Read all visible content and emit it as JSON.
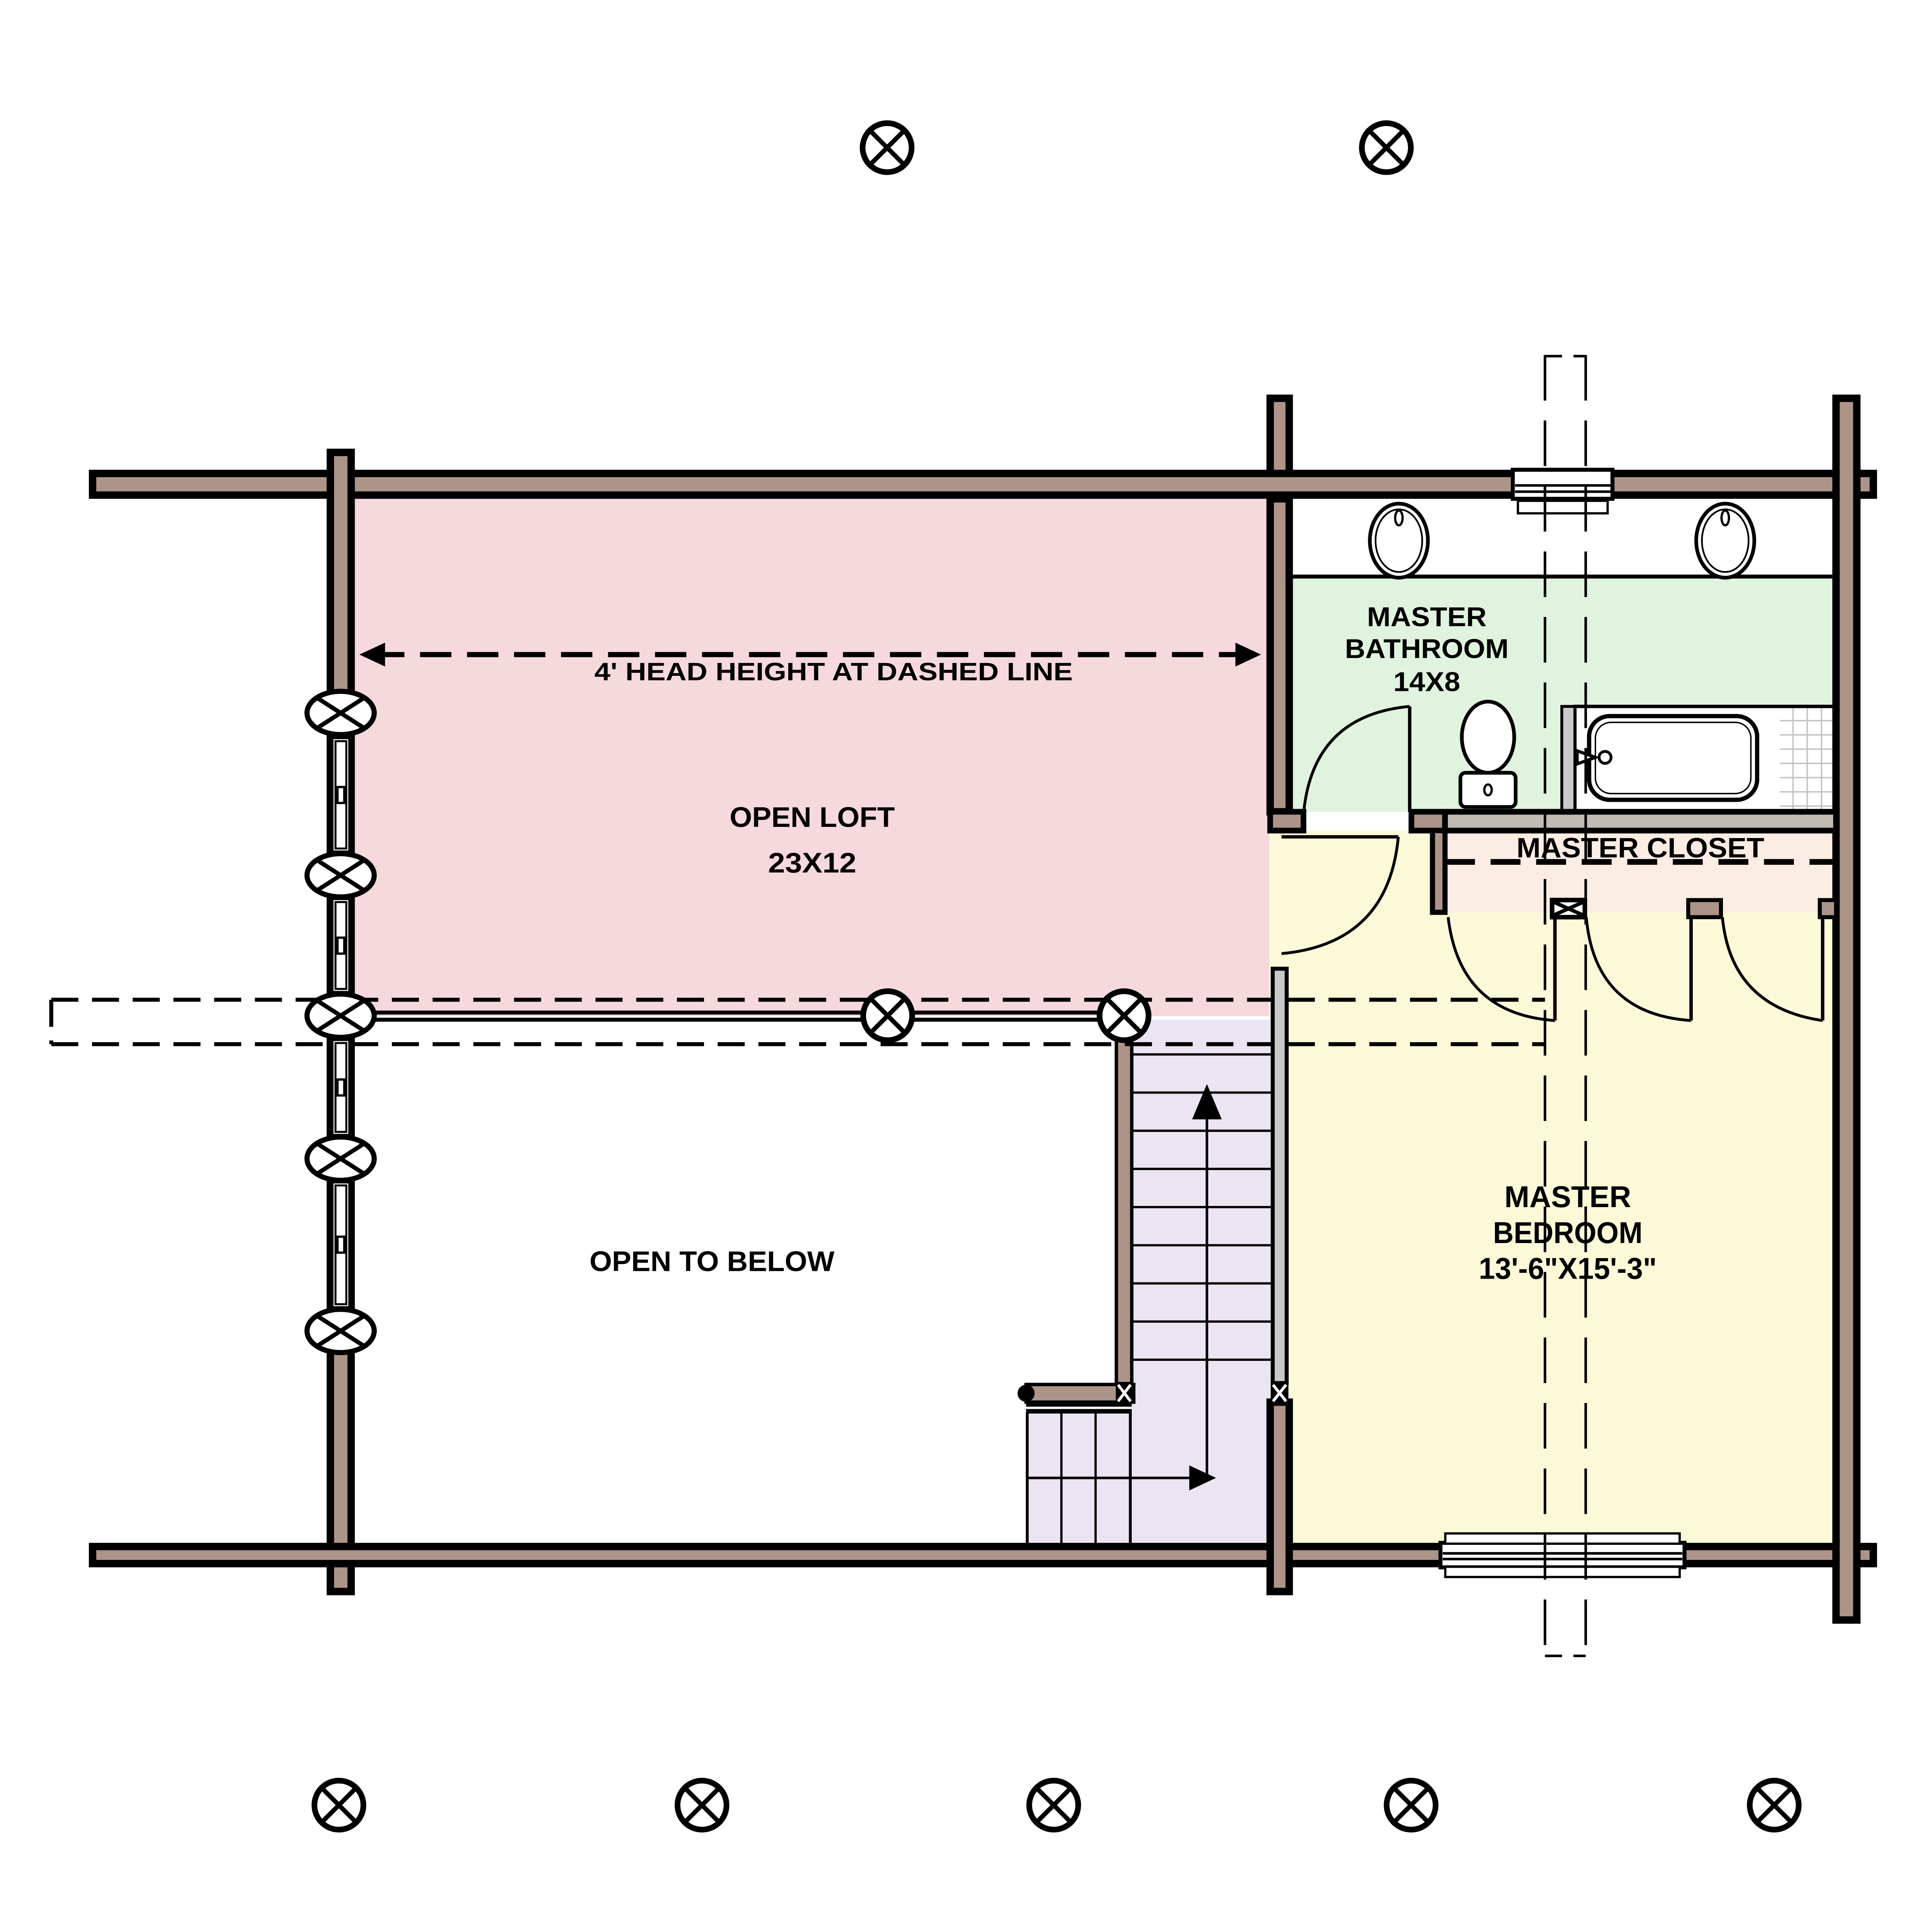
{
  "title": "Log Home Loft Level Floor Plan",
  "labels": {
    "head_height": "4' HEAD HEIGHT AT DASHED LINE",
    "open_loft_1": "OPEN LOFT",
    "open_loft_2": "23X12",
    "master_bathroom_1": "MASTER",
    "master_bathroom_2": "BATHROOM",
    "master_bathroom_3": "14X8",
    "master_closet": "MASTER CLOSET",
    "master_bedroom_1": "MASTER",
    "master_bedroom_2": "BEDROOM",
    "master_bedroom_3": "13'-6\"X15'-3\"",
    "open_to_below": "OPEN TO BELOW"
  },
  "rooms": [
    {
      "id": "open_loft",
      "name": "OPEN LOFT",
      "size": "23X12"
    },
    {
      "id": "master_bathroom",
      "name": "MASTER BATHROOM",
      "size": "14X8"
    },
    {
      "id": "master_closet",
      "name": "MASTER CLOSET",
      "size": ""
    },
    {
      "id": "master_bedroom",
      "name": "MASTER BEDROOM",
      "size": "13'-6\"X15'-3\""
    },
    {
      "id": "open_to_below",
      "name": "OPEN TO BELOW",
      "size": ""
    },
    {
      "id": "stairs",
      "name": "STAIRS",
      "size": ""
    }
  ],
  "colors": {
    "wall": "#ac9488",
    "outline": "#000000",
    "loft": "#f6d9dd",
    "bathroom": "#e0f3de",
    "closet": "#fbece4",
    "bedroom": "#fcf9d8",
    "stairs": "#ebe5f3",
    "half_wall": "#c9c9c9",
    "tub_wall_band": "#c2bbb3",
    "tile_line": "#c3c3c3",
    "white": "#ffffff"
  },
  "symbols": {
    "column_marker": "circled-x-log-column-marker",
    "wall_window": "double-line-window",
    "door": "quarter-arc-swing-door",
    "stair_direction": "up-arrow"
  }
}
